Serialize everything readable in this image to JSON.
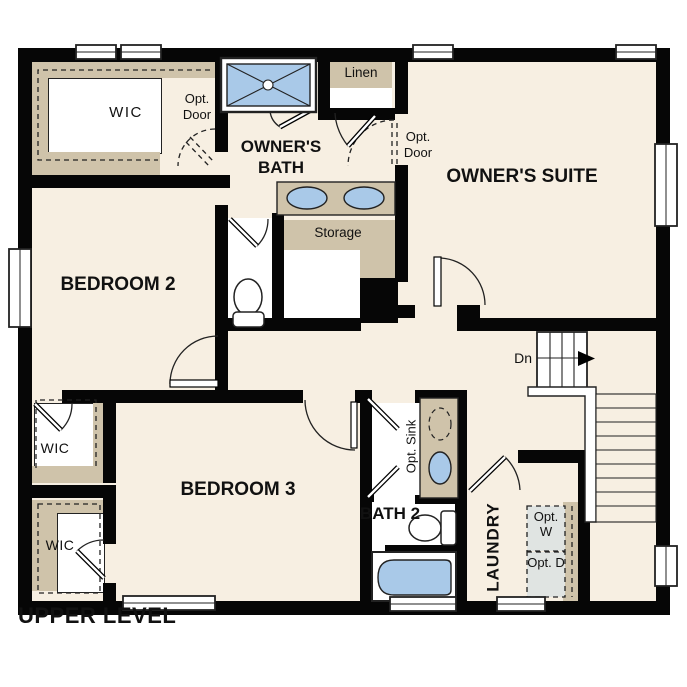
{
  "plan": {
    "title": "UPPER LEVEL",
    "level": "UPPER LEVEL"
  },
  "labels": {
    "upper_level": "UPPER LEVEL",
    "owners_suite": "OWNER'S SUITE",
    "owners_bath": "OWNER'S BATH",
    "bedroom2": "BEDROOM 2",
    "bedroom3": "BEDROOM 3",
    "bath2": "BATH 2",
    "laundry": "LAUNDRY",
    "wic_top": "WIC",
    "wic_mid": "WIC",
    "wic_bottom": "WIC",
    "linen": "Linen",
    "storage": "Storage",
    "opt_door_left": "Opt. Door",
    "opt_door_right": "Opt. Door",
    "opt_sink": "Opt. Sink",
    "opt_washer": "Opt. W",
    "opt_dryer": "Opt. D",
    "stairs_down": "Dn"
  },
  "colors": {
    "wall": "#060606",
    "floor": "#f7efe2",
    "casework_tan": "#cfc3aa",
    "fixture_blue": "#a9c9e8",
    "appliance_gray": "#e0e4e2",
    "background": "#ffffff"
  }
}
